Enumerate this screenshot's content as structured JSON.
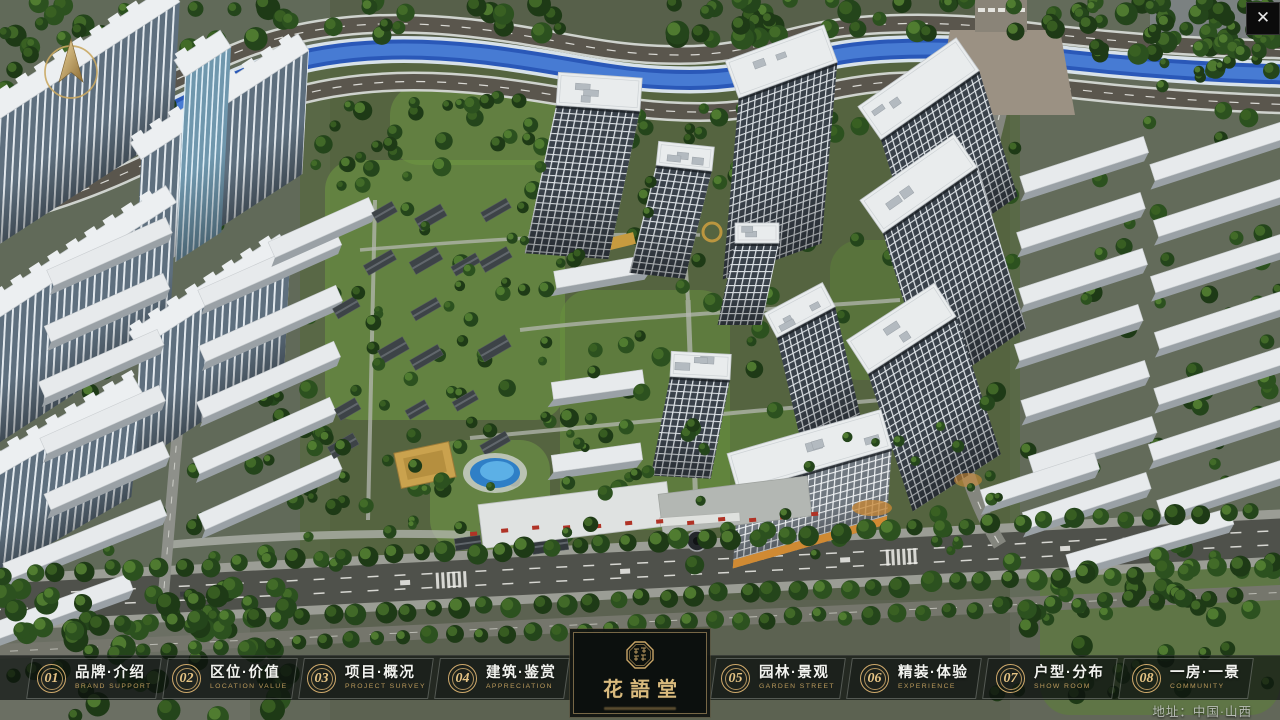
{
  "window": {
    "close_icon": "✕"
  },
  "nav": {
    "items": [
      {
        "num": "01",
        "label": "品牌·介绍",
        "sub": "BRAND SUPPORT"
      },
      {
        "num": "02",
        "label": "区位·价值",
        "sub": "LOCATION VALUE"
      },
      {
        "num": "03",
        "label": "项目·概况",
        "sub": "PROJECT SURVEY"
      },
      {
        "num": "04",
        "label": "建筑·鉴赏",
        "sub": "APPRECIATION"
      },
      {
        "num": "05",
        "label": "园林·景观",
        "sub": "GARDEN STREET"
      },
      {
        "num": "06",
        "label": "精装·体验",
        "sub": "EXPERIENCE"
      },
      {
        "num": "07",
        "label": "户型·分布",
        "sub": "SHOW ROOM"
      },
      {
        "num": "08",
        "label": "一房·一景",
        "sub": "COMMUNITY"
      }
    ]
  },
  "logo": {
    "title": "花語堂"
  },
  "footer": {
    "address": "地址：中国·山西"
  },
  "colors": {
    "gold": "#C9A567",
    "nav_bg": "rgba(8,12,10,0.66)",
    "nav_text": "#F2F3EF",
    "nav_sub": "#BB9A5C",
    "logo_text": "#D9BA7D",
    "river": "#2A58B8",
    "grass": "#53683A",
    "road": "#4F514B"
  }
}
